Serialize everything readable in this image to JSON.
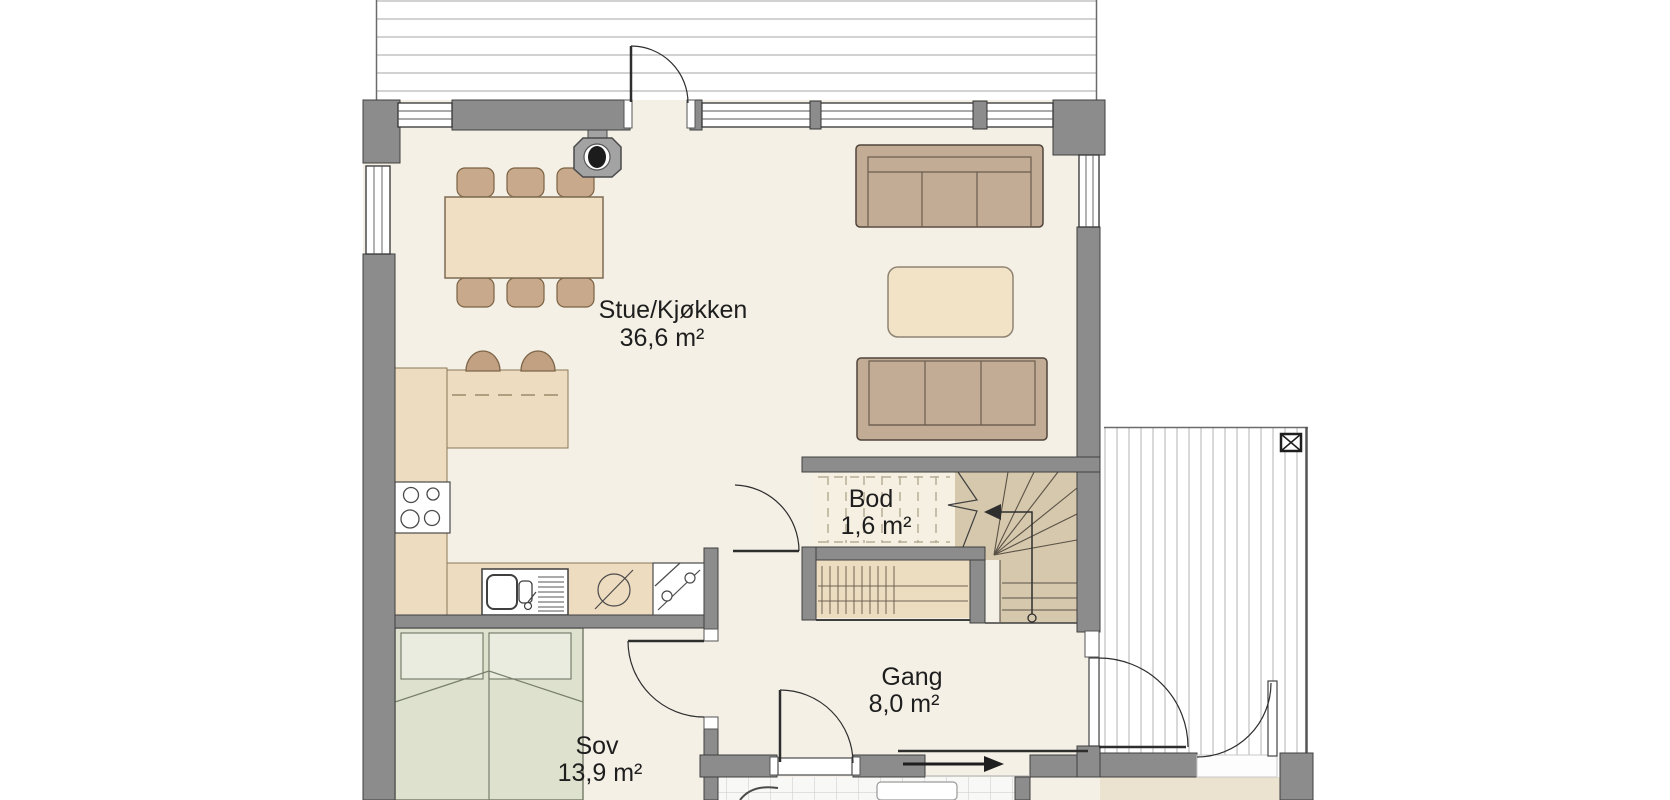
{
  "document": {
    "type": "architectural floor plan",
    "language": "Norwegian"
  },
  "rooms": [
    {
      "name": "Stue/Kjøkken",
      "area": "36,6 m²"
    },
    {
      "name": "Bod",
      "area": "1,6 m²"
    },
    {
      "name": "Gang",
      "area": "8,0 m²"
    },
    {
      "name": "Sov",
      "area": "13,9 m²"
    }
  ],
  "symbols": {
    "stair_direction_arrow": "up, turning left",
    "entrance_arrow": "points right",
    "deck_post_marker": "box with X"
  },
  "colors": {
    "wall": "#8c8c8c",
    "floor": "#f4f0e6",
    "counter": "#eedcc0",
    "wood_furniture": "#c9a98c",
    "sofa": "#c3ac96",
    "bed": "#dee1cd",
    "stairs": "#d6c8ad",
    "storage_floor": "#f6f0e2",
    "deck_lines": "#b3b3b3",
    "label_text": "#1e1e1e"
  }
}
